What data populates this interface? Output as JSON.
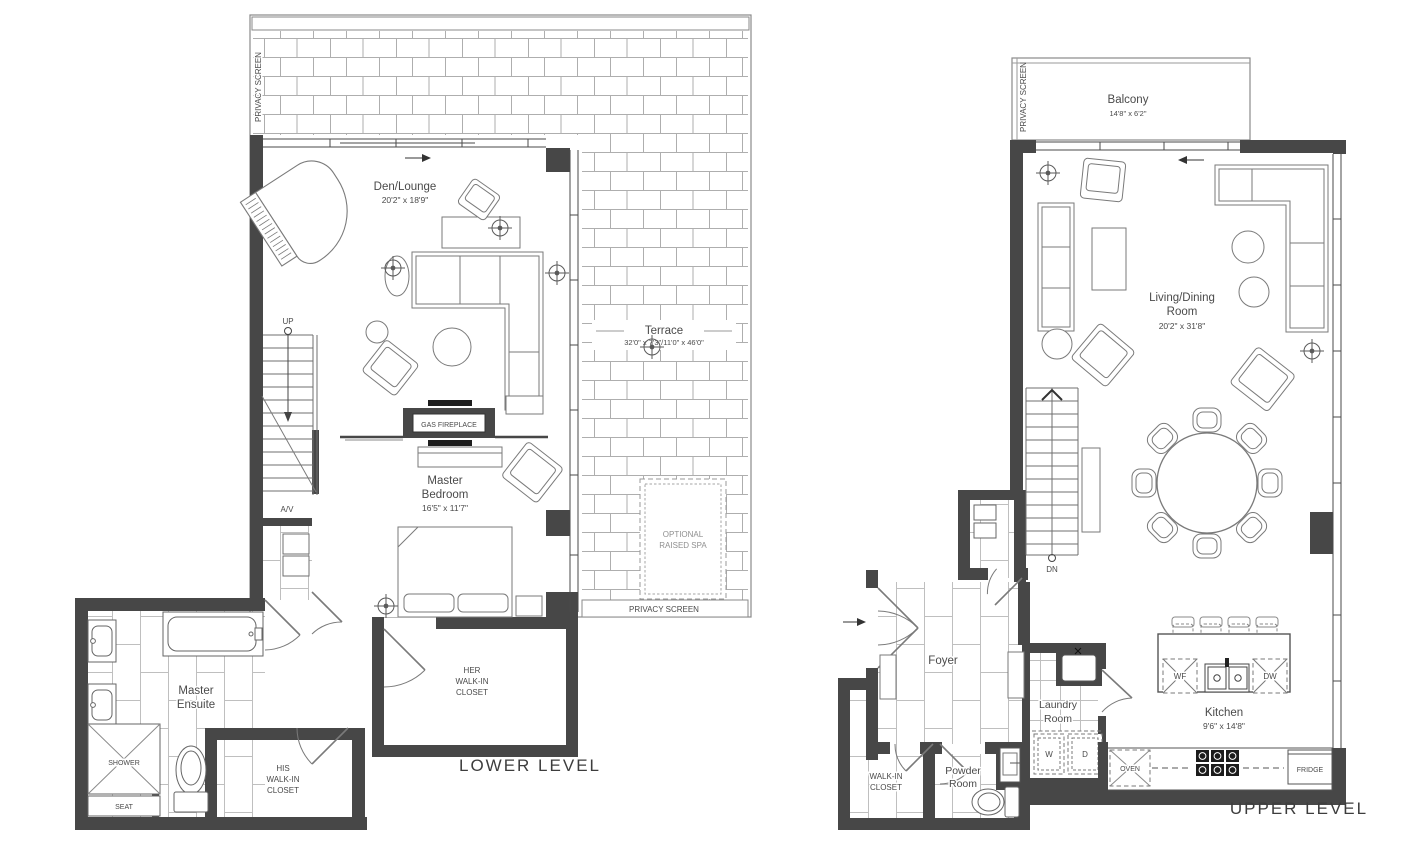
{
  "plan": {
    "lower": {
      "title": "LOWER LEVEL",
      "privacy_screen_left": "PRIVACY SCREEN",
      "privacy_screen_bottom": "PRIVACY SCREEN",
      "den": {
        "name": "Den/Lounge",
        "dims": "20'2\" x 18'9\""
      },
      "terrace": {
        "name": "Terrace",
        "dims": "32'0\" x 7'3\"/11'0\" x 46'0\""
      },
      "spa": {
        "line1": "OPTIONAL",
        "line2": "RAISED SPA"
      },
      "master_bedroom": {
        "line1": "Master",
        "line2": "Bedroom",
        "dims": "16'5\" x 11'7\""
      },
      "master_ensuite": {
        "line1": "Master",
        "line2": "Ensuite"
      },
      "her_closet": {
        "line1": "HER",
        "line2": "WALK-IN",
        "line3": "CLOSET"
      },
      "his_closet": {
        "line1": "HIS",
        "line2": "WALK-IN",
        "line3": "CLOSET"
      },
      "gas_fireplace": "GAS FIREPLACE",
      "shower": "SHOWER",
      "seat": "SEAT",
      "up": "UP",
      "av": "A/V"
    },
    "upper": {
      "title": "UPPER LEVEL",
      "privacy_screen_left": "PRIVACY SCREEN",
      "balcony": {
        "name": "Balcony",
        "dims": "14'8\" x 6'2\""
      },
      "living_dining": {
        "line1": "Living/Dining",
        "line2": "Room",
        "dims": "20'2\" x 31'8\""
      },
      "foyer": {
        "name": "Foyer"
      },
      "walk_in_closet": {
        "line1": "WALK-IN",
        "line2": "CLOSET"
      },
      "powder_room": {
        "line1": "Powder",
        "line2": "Room"
      },
      "laundry_room": {
        "line1": "Laundry",
        "line2": "Room"
      },
      "kitchen": {
        "name": "Kitchen",
        "dims": "9'6\" x 14'8\""
      },
      "washer": "W",
      "dryer": "D",
      "wine_fridge": "WF",
      "dishwasher": "DW",
      "oven": "OVEN",
      "fridge": "FRIDGE",
      "dn": "DN"
    }
  },
  "colors": {
    "wall": "#474747",
    "furniture_line": "#7a7a7a",
    "pattern_line": "#b5b5b5",
    "text": "#4a4a4a"
  }
}
